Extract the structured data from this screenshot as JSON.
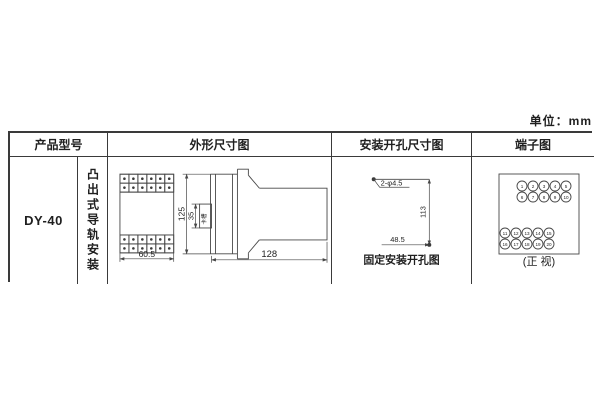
{
  "unit_label": "单位：mm",
  "table": {
    "headers": {
      "model": "产品型号",
      "outline": "外形尺寸图",
      "install": "安装开孔尺寸图",
      "terminal": "端子图"
    },
    "model": "DY-40",
    "mounting": "凸出式导轨安装"
  },
  "outline": {
    "width": "60.5",
    "height": "125",
    "slot_height": "35",
    "slot_label": "卡槽",
    "depth": "128"
  },
  "install": {
    "holes_label": "2-φ4.5",
    "height": "113",
    "width": "48.5",
    "caption": "固定安装开孔图"
  },
  "terminal": {
    "caption": "(正 视)",
    "top_rows": [
      [
        "1",
        "2",
        "3",
        "4",
        "5"
      ],
      [
        "6",
        "7",
        "8",
        "9",
        "10"
      ]
    ],
    "bottom_rows": [
      [
        "11",
        "12",
        "13",
        "14",
        "15"
      ],
      [
        "16",
        "17",
        "18",
        "19",
        "20"
      ]
    ]
  },
  "colors": {
    "line": "#474747",
    "text": "#1f1f1f"
  }
}
